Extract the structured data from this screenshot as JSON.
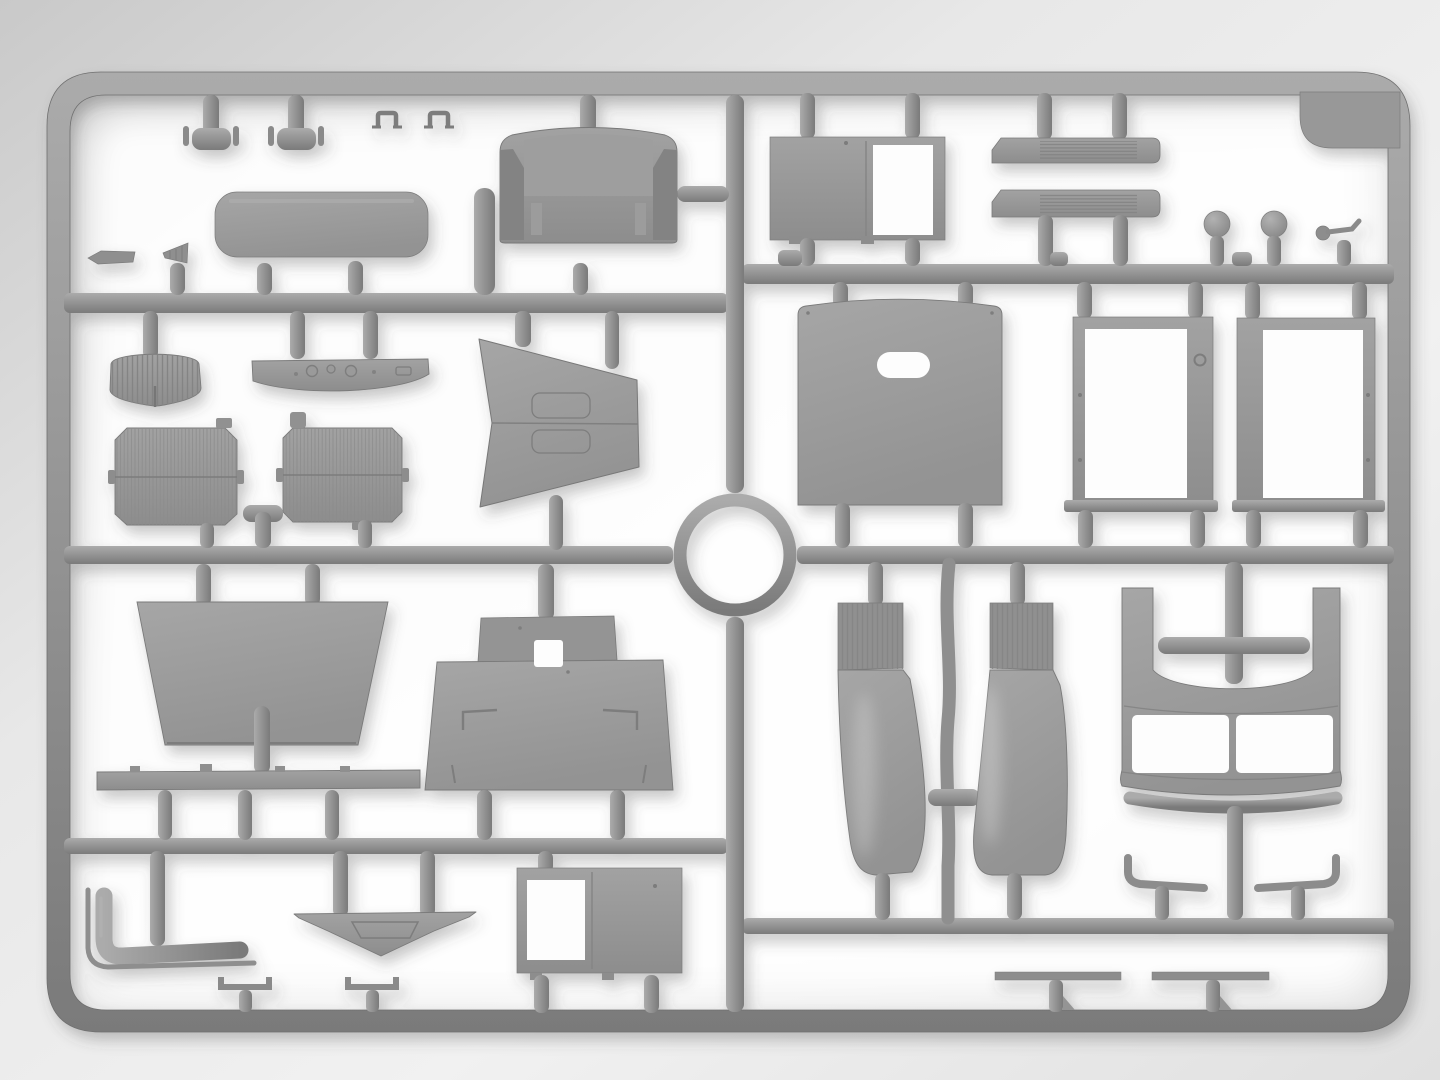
{
  "meta": {
    "title": "Model kit sprue — gray plastic parts frame",
    "description": "Top-down photograph of a light-gray injection-molded model kit sprue (parts frame) holding truck cab parts: seat, cushion, doors, door frames, radiator cores, grille shell, dashboard, windshield cowl, hood, fenders, running boards, exhaust pipe, roof panel and small fittings, connected by runner rails with a circular ring at the center."
  },
  "colors": {
    "background": "#e4e4e4",
    "background_edge": "#c9c9c9",
    "glow": "#ffffff",
    "plastic": "#959595",
    "plastic_light": "#ababab",
    "plastic_dark": "#7a7a7a",
    "plastic_flat": "#9a9a9a",
    "plastic_flat_dark": "#8d8d8d",
    "line": "#7d7d7d",
    "cutout": "#fdfdfd"
  },
  "parts": [
    {
      "label": "sprue outer frame"
    },
    {
      "label": "center runner ring"
    },
    {
      "label": "runner rails and gates"
    },
    {
      "label": "T-shaped peg pair"
    },
    {
      "label": "small U-bracket pair"
    },
    {
      "label": "seat cushion"
    },
    {
      "label": "small blade part"
    },
    {
      "label": "small cone part"
    },
    {
      "label": "bench seat backrest"
    },
    {
      "label": "radiator grille shell"
    },
    {
      "label": "dashboard panel"
    },
    {
      "label": "windshield cowl wedge"
    },
    {
      "label": "radiator core left"
    },
    {
      "label": "radiator core right"
    },
    {
      "label": "rear panel trapezoid"
    },
    {
      "label": "chassis crossbar strip"
    },
    {
      "label": "engine hood top"
    },
    {
      "label": "exhaust pipe"
    },
    {
      "label": "V-shaped bumper brace"
    },
    {
      "label": "lower cab door with window"
    },
    {
      "label": "wiper strip pair"
    },
    {
      "label": "upper cab door with window"
    },
    {
      "label": "running board pair"
    },
    {
      "label": "round knob pair"
    },
    {
      "label": "gear lever"
    },
    {
      "label": "corner gusset tab"
    },
    {
      "label": "cab back panel with slot"
    },
    {
      "label": "door frame left"
    },
    {
      "label": "door frame right"
    },
    {
      "label": "fender pair with center rod"
    },
    {
      "label": "cab roof front panel with windshield openings"
    },
    {
      "label": "grab handle pair"
    },
    {
      "label": "leaf spring strip pair"
    }
  ]
}
